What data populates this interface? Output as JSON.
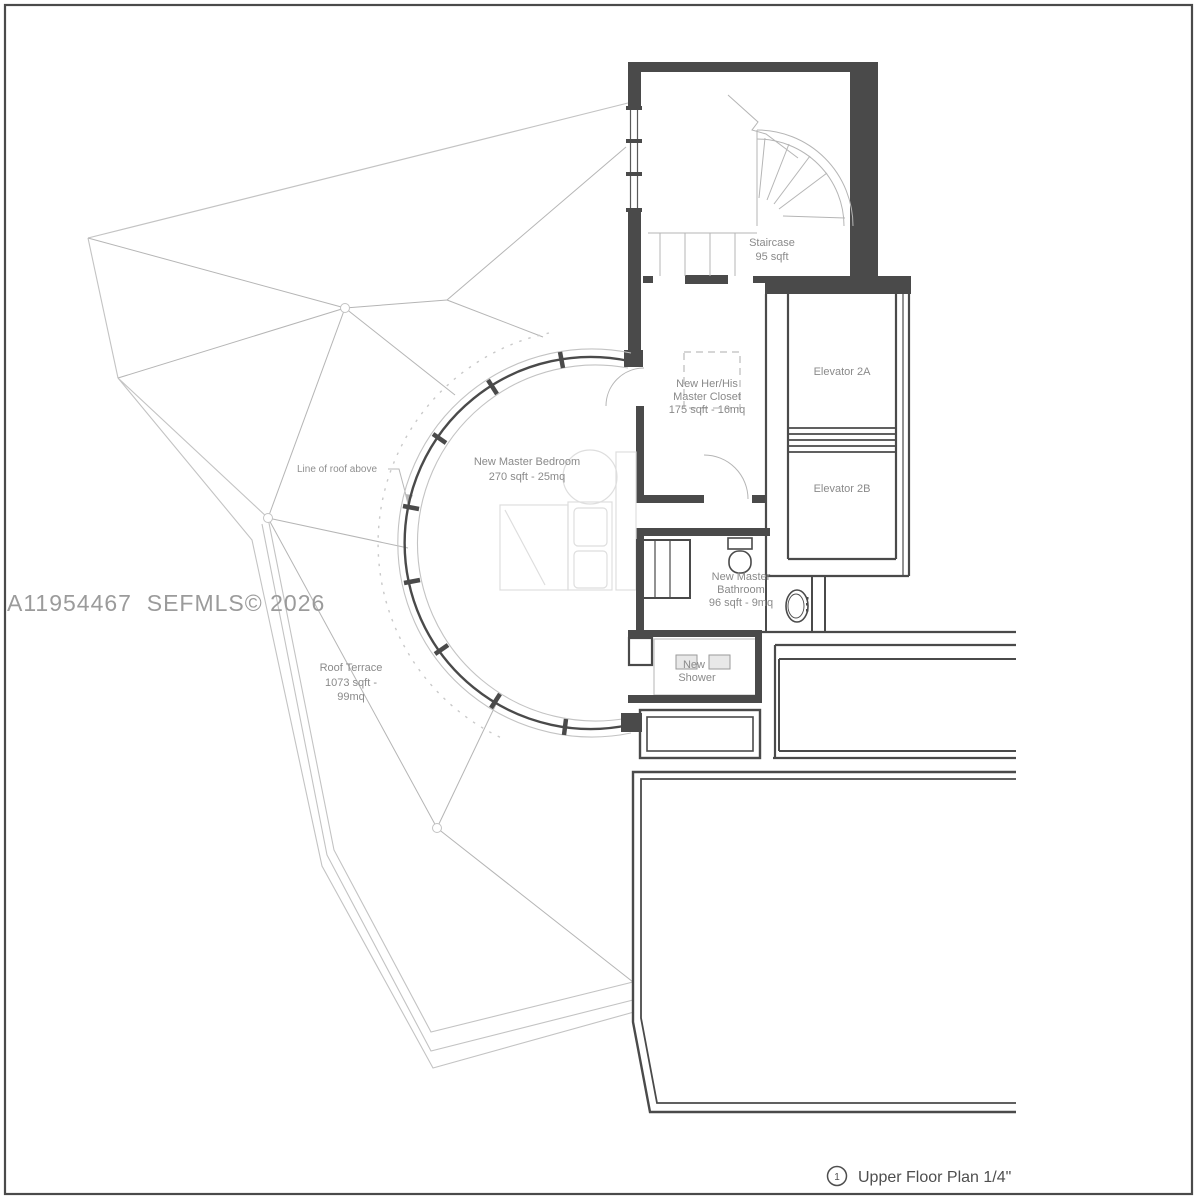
{
  "watermark": "A11954467  SEFMLS© 2026",
  "title": {
    "marker": "1",
    "text": "Upper Floor Plan 1/4\""
  },
  "labels": {
    "staircase": {
      "name": "Staircase",
      "area": "95 sqft"
    },
    "closet": {
      "l1": "New Her/His",
      "l2": "Master Closet",
      "l3": "175 sqft - 16mq"
    },
    "elevator_a": "Elevator 2A",
    "elevator_b": "Elevator 2B",
    "bedroom": {
      "l1": "New Master Bedroom",
      "l2": "270 sqft - 25mq"
    },
    "bathroom": {
      "l1": "New Master",
      "l2": "Bathroom",
      "l3": "96 sqft - 9mq"
    },
    "shower": {
      "l1": "New",
      "l2": "Shower"
    },
    "terrace": {
      "l1": "Roof Terrace",
      "l2": "1073 sqft -",
      "l3": "99mq"
    },
    "roof_note": "Line of roof above"
  },
  "colors": {
    "wall": "#4a4a4a",
    "light_line": "#c3c3c3",
    "faint_line": "#dedede",
    "label_text": "#8a8a8a",
    "watermark_text": "#9b9b9b",
    "title_text": "#4e4e4e",
    "background": "#ffffff"
  }
}
